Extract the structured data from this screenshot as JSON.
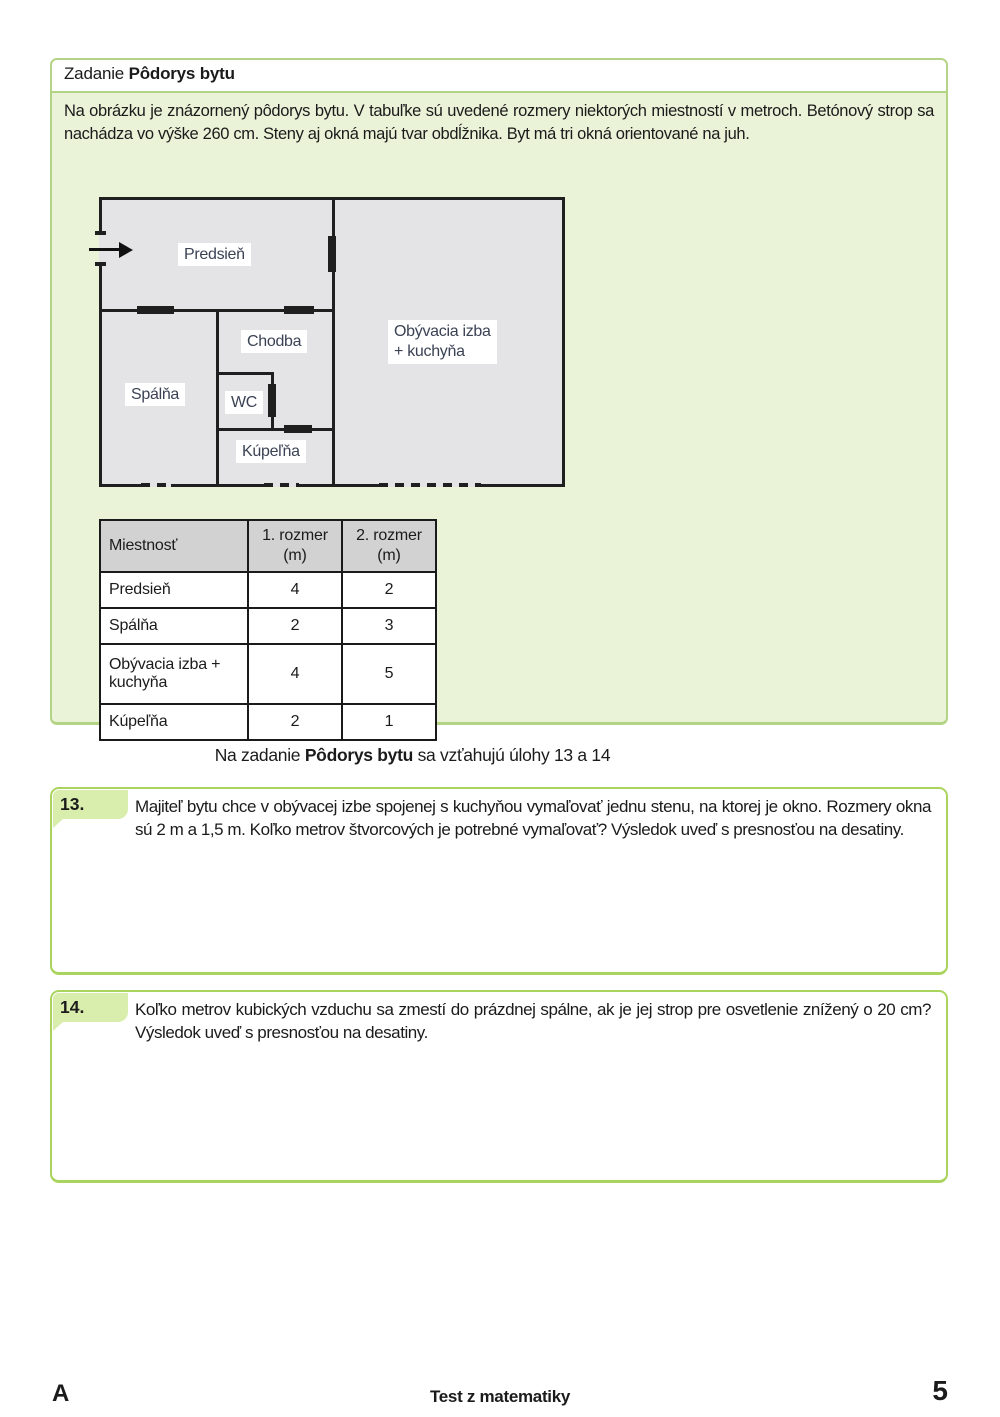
{
  "task_box": {
    "title_prefix": "Zadanie ",
    "title_bold": "Pôdorys bytu",
    "intro": "Na obrázku je znázornený pôdorys bytu. V tabuľke sú uvedené rozmery niektorých miestností v metroch. Betónový strop sa nachádza vo výške 260 cm. Steny aj okná majú tvar obdĺžnika. Byt má tri okná orientované na juh.",
    "floorplan": {
      "labels": {
        "predsien": "Predsieň",
        "chodba": "Chodba",
        "obyvacia_line1": "Obývacia izba",
        "obyvacia_line2": "+ kuchyňa",
        "spalna": "Spálňa",
        "wc": "WC",
        "kupelna": "Kúpeľňa"
      },
      "windows_note": "three dashed wall segments on south (bottom) wall",
      "entrance_icon": "entrance-arrow"
    },
    "table": {
      "headers": [
        "Miestnosť",
        "1. rozmer (m)",
        "2. rozmer (m)"
      ],
      "rows": [
        [
          "Predsieň",
          "4",
          "2"
        ],
        [
          "Spálňa",
          "2",
          "3"
        ],
        [
          "Obývacia izba + kuchyňa",
          "4",
          "5"
        ],
        [
          "Kúpeľňa",
          "2",
          "1"
        ]
      ]
    }
  },
  "relation": {
    "prefix": "Na zadanie ",
    "bold": "Pôdorys bytu",
    "suffix": " sa vzťahujú úlohy 13 a 14"
  },
  "questions": [
    {
      "number": "13.",
      "text": "Majiteľ bytu chce v obývacej izbe spojenej s kuchyňou vymaľovať jednu stenu, na ktorej je okno. Rozmery okna sú 2 m a 1,5 m. Koľko metrov štvorcových je potrebné vymaľovať? Výsledok uveď s presnosťou na desatiny."
    },
    {
      "number": "14.",
      "text": "Koľko metrov kubických vzduchu sa zmestí do prázdnej spálne, ak je jej strop pre osvetlenie znížený o 20 cm? Výsledok uveď s presnosťou na desatiny."
    }
  ],
  "footer": {
    "variant": "A",
    "center": "Test z matematiky",
    "page": "5"
  },
  "colors": {
    "task_box_border": "#b3d484",
    "task_box_bg": "#eaf3d8",
    "question_box_border": "#abd45f",
    "question_tab_bg": "#d9edad",
    "plan_fill": "#e4e4e6",
    "plan_label_text": "#3a4254",
    "table_header_bg": "#d2d2d2",
    "text": "#1b1b1b"
  }
}
